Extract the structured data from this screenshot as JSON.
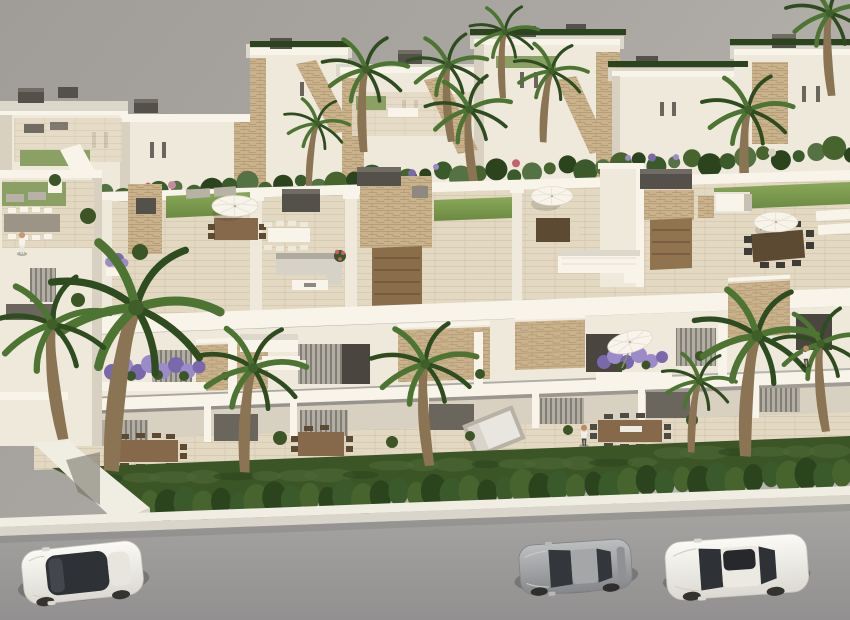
{
  "meta": {
    "type": "natural-image",
    "subject": "Aerial 3D architectural rendering of a modern white residential development with rooftop solariums, terraces, gardens, palm trees and a street with parked cars",
    "width": 850,
    "height": 620
  },
  "palette": {
    "white_sun": "#f8f4ea",
    "white_lit": "#efe9dc",
    "white_shade": "#d8d0c0",
    "white_deep": "#c0b6a4",
    "roof_slab": "#dcd7cb",
    "cream": "#e3d9c3",
    "cream_shade": "#cfc4ab",
    "stone": "#c9b28c",
    "stone_dark": "#a8906a",
    "cap": "#54504a",
    "cap_top": "#716c63",
    "glass": "#4a463f",
    "glass_dim": "#6a655d",
    "curtain": "#b3aea4",
    "lawn_bright": "#84a355",
    "lawn": "#6b8a42",
    "lawn_dull": "#8aa065",
    "grass_dark": "#3c5527",
    "grass_deep": "#2c441d",
    "hedge": "#47642f",
    "palm": "#4e7434",
    "palm_dark": "#2f4b20",
    "trunk": "#8b7454",
    "trunk_dark": "#6e5a40",
    "purple": "#9b8bc9",
    "purple_deep": "#7a68ad",
    "red_flower": "#c9606e",
    "wood": "#86694a",
    "wood_dark": "#5d4a33",
    "gray_furn": "#b7b1a6",
    "backdrop_a": "#a29e9a",
    "backdrop_b": "#b6b2ac",
    "road_a": "#a5a3a0",
    "road_b": "#949290",
    "wall_sun": "#f0ede3",
    "wall_face": "#d9d5cb",
    "car_white": "#f4f2ee",
    "car_silver": "#a8aaac"
  },
  "scene": {
    "backdrop": {
      "label": "plain warm-gray ground backdrop"
    },
    "background_villas": {
      "count": 7,
      "style": "white flat-roof villas with travertine stone accents, dark roof vents, window slits"
    },
    "main_block": {
      "units": 5,
      "roof_solarium": {
        "lawn_strips": 4,
        "umbrellas": 3,
        "dining_sets": 4,
        "corner_sofas": 2,
        "sun_loungers": 4,
        "stone_stair_towers": 3,
        "dark_roof_caps": 4,
        "day_beds": 1
      },
      "terrace_level": {
        "purple_flower_planters": 2,
        "stone_feature_panels": 4,
        "tilted_umbrella": 1,
        "white_sofas": 2,
        "louver_shutters": 1
      },
      "ground_level": {
        "wood_dining_sets": 3,
        "gray_day_bed": 1,
        "curtained_openings": 7
      }
    },
    "garden": {
      "front_lawn": "dark green strip",
      "hedge_bushes": 40,
      "lawn_mottles": 24
    },
    "back_garden": {
      "shrub_blobs": 46
    },
    "palm_trees": {
      "background": 7,
      "foreground": 6
    },
    "street": {
      "sidewalk": "white boundary wall with sunlit cap",
      "road": "gray asphalt",
      "cars": [
        {
          "type": "suv",
          "color": "white",
          "position": "bottom-left"
        },
        {
          "type": "sports-coupe",
          "color": "silver-gray",
          "position": "bottom-center"
        },
        {
          "type": "sedan",
          "color": "white",
          "position": "bottom-right"
        }
      ]
    },
    "people": [
      {
        "position": "left neighbor rooftop",
        "clothing": "white"
      },
      {
        "position": "right ground terrace",
        "clothing": "white shirt, dark trousers"
      },
      {
        "position": "far-right upper terrace",
        "clothing": "white top, dark trousers"
      }
    ]
  }
}
